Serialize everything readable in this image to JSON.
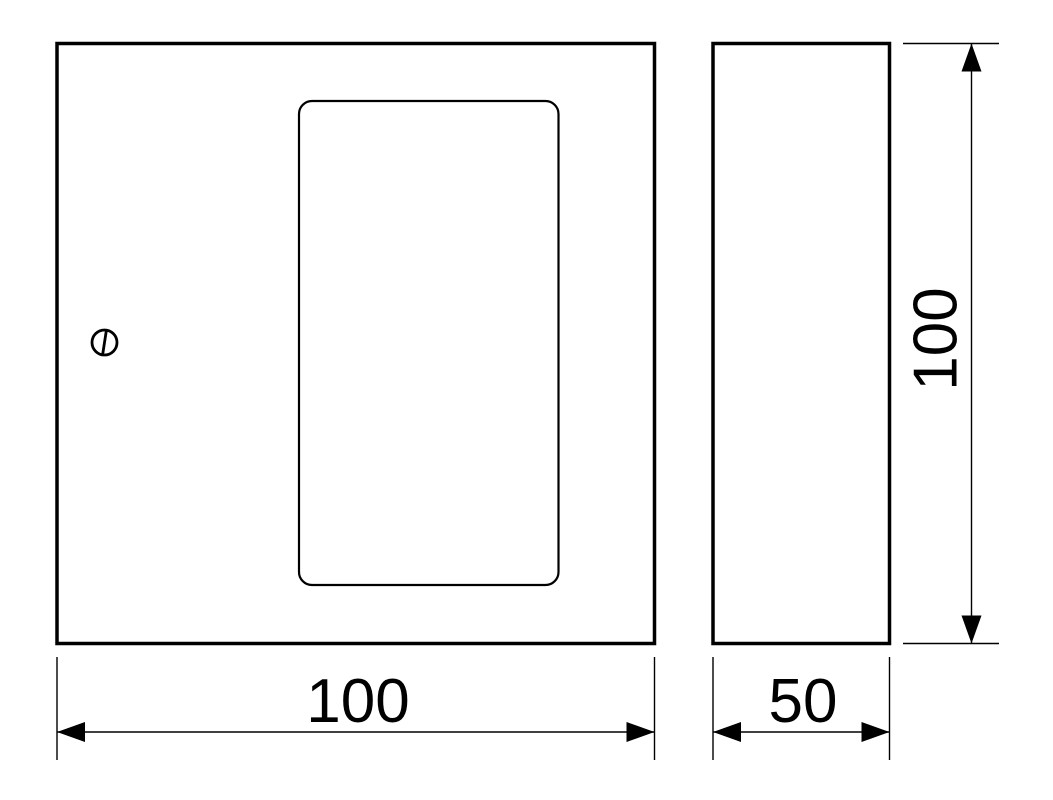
{
  "drawing": {
    "background_color": "#ffffff",
    "line_color": "#000000",
    "views": {
      "front": {
        "name": "front view",
        "features": [
          "door panel outline",
          "screw slot"
        ]
      },
      "side": {
        "name": "side view"
      }
    },
    "dimensions": {
      "front_width": {
        "label": "100",
        "orientation": "horizontal"
      },
      "side_width": {
        "label": "50",
        "orientation": "horizontal"
      },
      "side_height": {
        "label": "100",
        "orientation": "vertical"
      }
    }
  }
}
